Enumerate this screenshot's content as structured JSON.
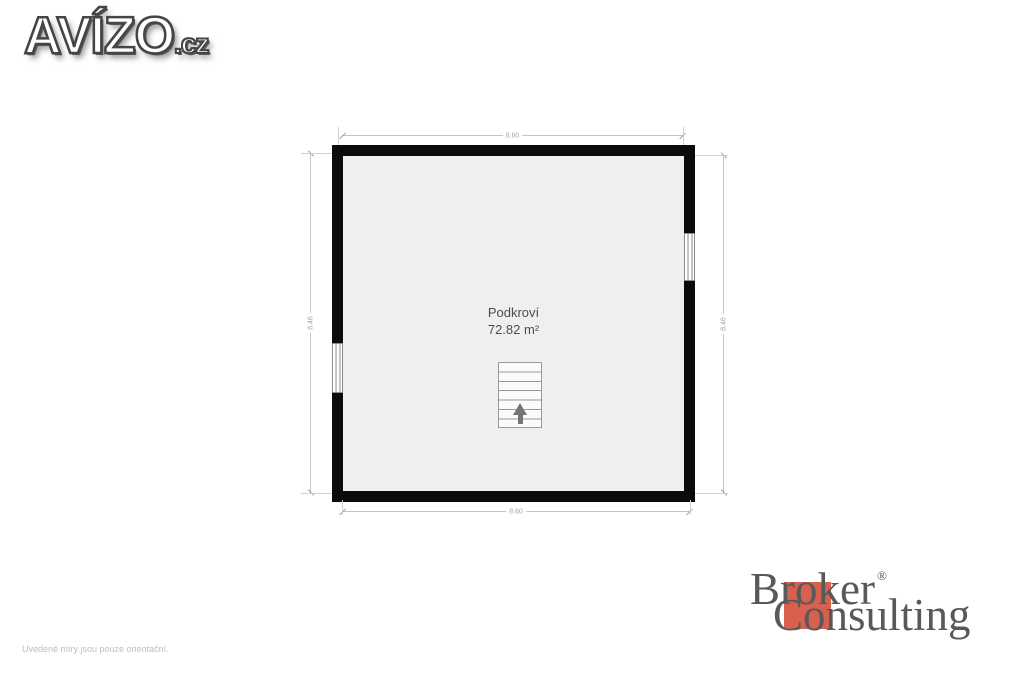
{
  "site_logo": {
    "text": "AVÍZO",
    "suffix": ".cz"
  },
  "plan": {
    "room_name": "Podkroví",
    "room_area": "72.82 m²",
    "dim_top": "8.60",
    "dim_bottom": "8.60",
    "dim_left": "8.46",
    "dim_right": "8.46",
    "colors": {
      "wall": "#0b0b0b",
      "floor": "#efefef",
      "dimension_line": "#c4c4c4",
      "dimension_text": "#a6a6a6",
      "room_text": "#4c4c4c"
    },
    "stairs": {
      "icon": "stairs-up-icon",
      "direction": "up"
    }
  },
  "footer": {
    "disclaimer": "Uvedené míry jsou pouze orientační."
  },
  "broker_logo": {
    "line1": "Broker",
    "reg": "®",
    "line2": "Consulting",
    "accent_color": "#d8604f",
    "text_color": "#58595b"
  }
}
